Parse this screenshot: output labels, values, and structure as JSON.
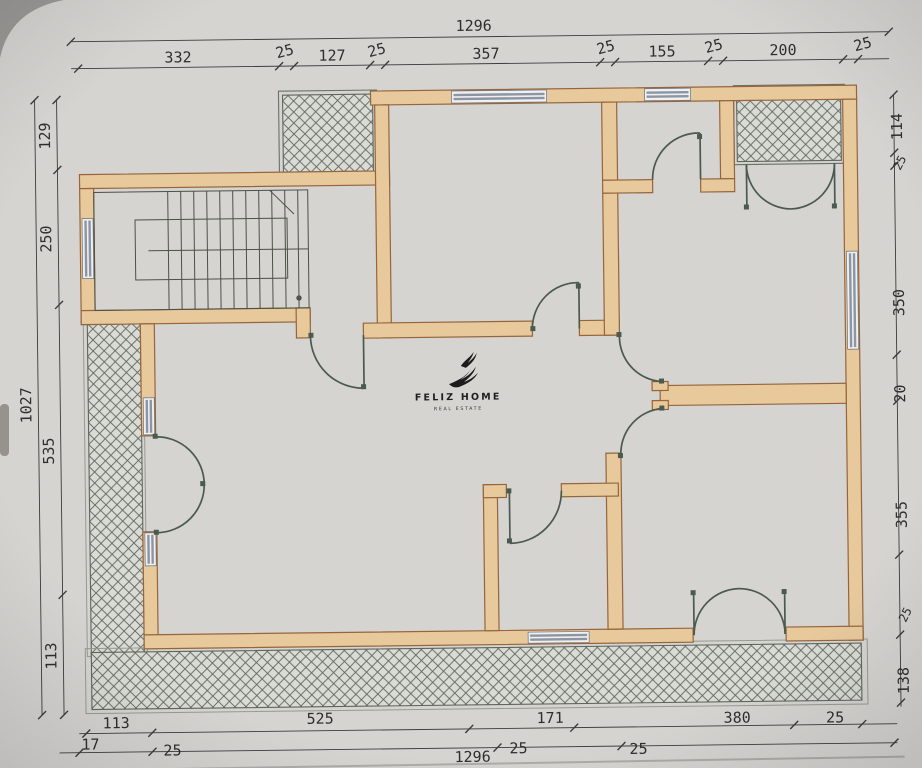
{
  "brand": {
    "name": "FELIZ HOME",
    "tagline": "REAL ESTATE",
    "icon": "flame-swoosh-icon"
  },
  "dimensions": {
    "top": {
      "total": "1296",
      "segments": [
        "332",
        "25",
        "127",
        "25",
        "357",
        "25",
        "155",
        "25",
        "200",
        "25"
      ]
    },
    "left": {
      "total": "1027",
      "segments": [
        "129",
        "250",
        "535",
        "113"
      ]
    },
    "right": {
      "segments": [
        "114",
        "25",
        "350",
        "20",
        "355",
        "25",
        "138"
      ]
    },
    "bottom": {
      "row1": [
        "113",
        "525",
        "171",
        "380",
        "25"
      ],
      "row2": [
        "17",
        "25",
        "1296",
        "25",
        "25"
      ]
    }
  },
  "colors": {
    "paper": "#d6d4d1",
    "wall": "#e7c99c",
    "wall_outline": "#96653d",
    "door": "#4b5a4e",
    "window": "#8d94a2",
    "dimension_text": "#2e2e2e",
    "hatch_line": "#5d675d"
  }
}
